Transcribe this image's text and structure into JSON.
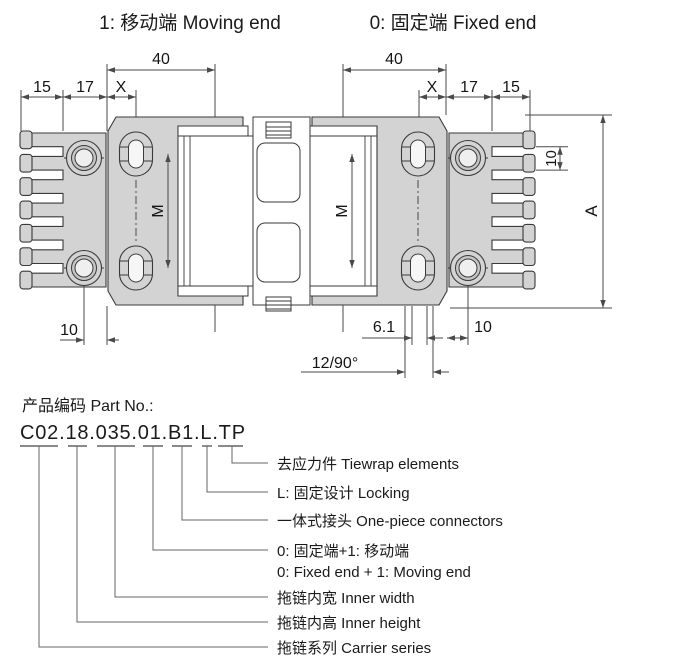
{
  "legend": {
    "moving_end": "1: 移动端 Moving end",
    "fixed_end": "0: 固定端 Fixed end"
  },
  "dims": {
    "left_15": "15",
    "left_17": "17",
    "left_x": "X",
    "left_40": "40",
    "right_40": "40",
    "right_x": "X",
    "right_17": "17",
    "right_15": "15",
    "m_left": "M",
    "m_right": "M",
    "a": "A",
    "tooth_pitch": "10",
    "bottom_left_10": "10",
    "slot_width": "6.1",
    "bottom_right_10": "10",
    "rotation": "12/90°"
  },
  "part_no": {
    "label": "产品编码 Part No.:",
    "code": "C02.18.035.01.B1.L.TP",
    "callouts": [
      {
        "text": "去应力件 Tiewrap elements"
      },
      {
        "text": "L: 固定设计 Locking"
      },
      {
        "text": "一体式接头 One-piece connectors"
      },
      {
        "text": "0: 固定端+1: 移动端",
        "text2": "0: Fixed end + 1: Moving end"
      },
      {
        "text": "拖链内宽 Inner width"
      },
      {
        "text": "拖链内高 Inner height"
      },
      {
        "text": "拖链系列 Carrier series"
      }
    ]
  },
  "colors": {
    "part_fill": "#d3d3d3",
    "outline": "#3a3a3a",
    "dimension": "#4a4a4a"
  }
}
